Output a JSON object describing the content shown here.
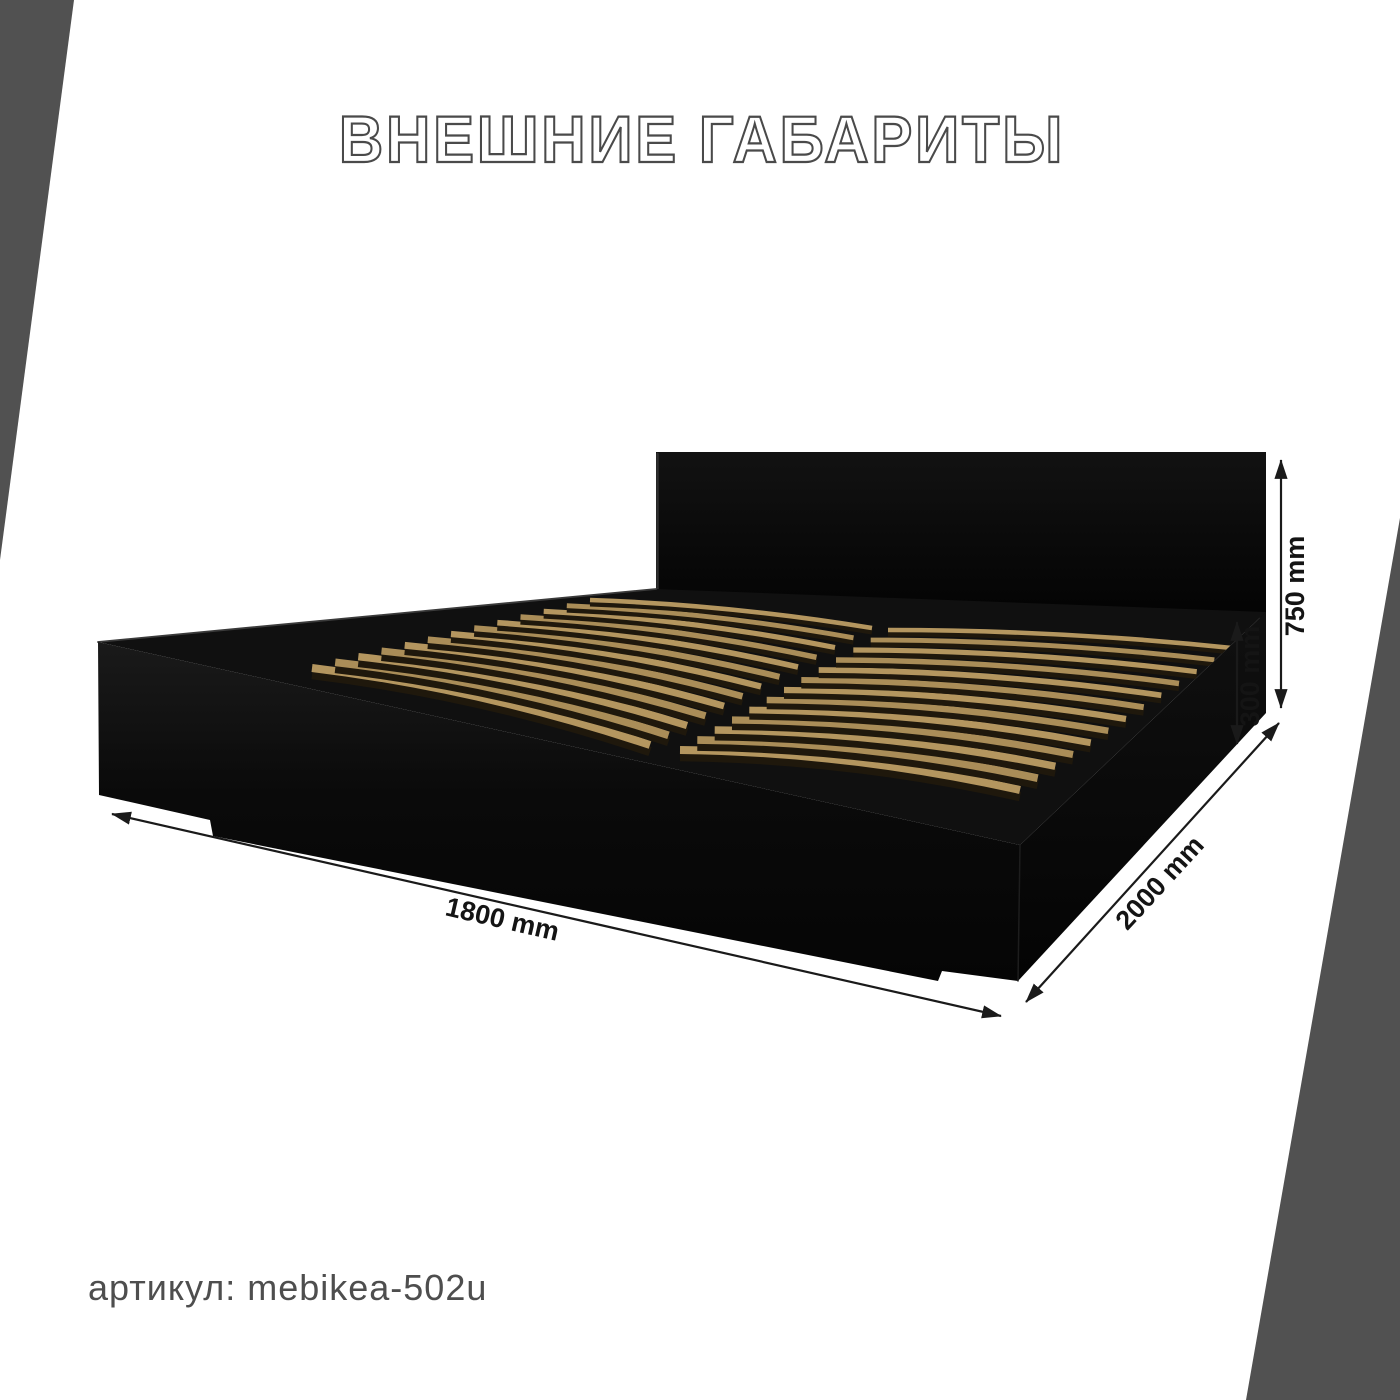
{
  "title": "ВНЕШНИЕ ГАБАРИТЫ",
  "article": "артикул: mebikea-502u",
  "dimensions": {
    "width": "1800 mm",
    "depth": "2000 mm",
    "height": "750 mm",
    "base_height": "300 mm"
  },
  "bed": {
    "slat_columns": 2,
    "slats_per_column": 13,
    "slat_color": "#b4965f",
    "slat_color_alt": "#aa8d58",
    "slat_shadow_color": "#1f180c",
    "frame_color": "#0a0a0a"
  },
  "decor": {
    "corner_color": "#515151"
  },
  "annotation_color": "#1a1a1a"
}
